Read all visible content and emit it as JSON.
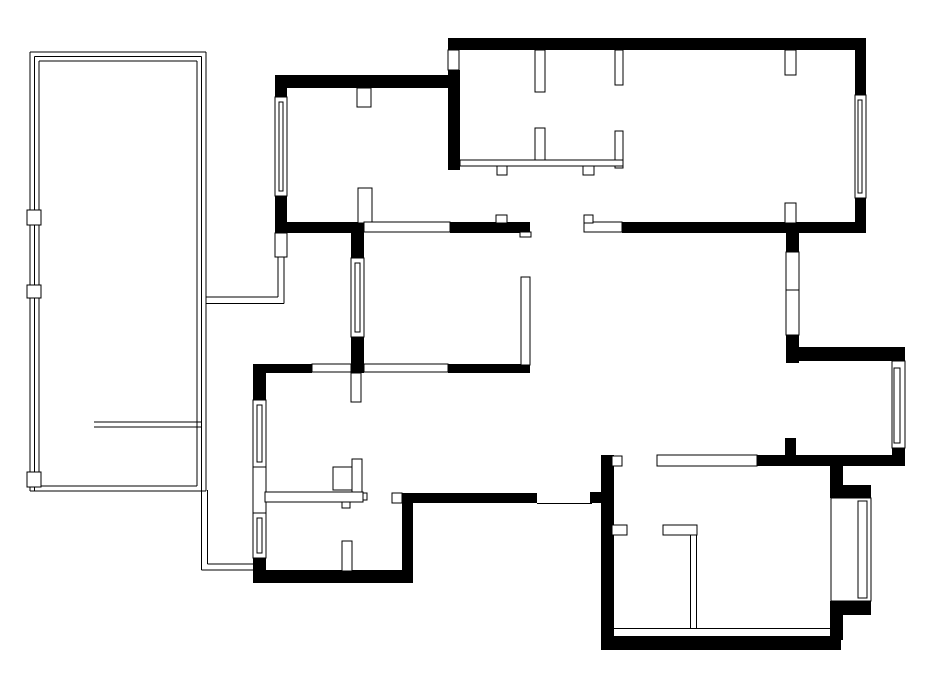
{
  "canvas": {
    "width": 934,
    "height": 674,
    "background": "#ffffff",
    "wall_color": "#000000",
    "line_color": "#000000",
    "fill_color": "#ffffff"
  },
  "walls": [
    [
      275,
      75,
      185,
      13
    ],
    [
      275,
      88,
      12,
      9
    ],
    [
      275,
      196,
      12,
      37
    ],
    [
      448,
      70,
      12,
      100
    ],
    [
      275,
      222,
      89,
      11
    ],
    [
      450,
      222,
      80,
      11
    ],
    [
      448,
      38,
      418,
      12
    ],
    [
      855,
      50,
      11,
      45
    ],
    [
      855,
      198,
      11,
      35
    ],
    [
      622,
      222,
      244,
      11
    ],
    [
      351,
      233,
      13,
      25
    ],
    [
      351,
      337,
      13,
      36
    ],
    [
      253,
      364,
      59,
      9
    ],
    [
      351,
      364,
      13,
      9
    ],
    [
      448,
      364,
      82,
      9
    ],
    [
      253,
      364,
      13,
      36
    ],
    [
      253,
      558,
      13,
      25
    ],
    [
      253,
      570,
      160,
      13
    ],
    [
      402,
      493,
      11,
      90
    ],
    [
      402,
      493,
      135,
      10
    ],
    [
      590,
      492,
      24,
      11
    ],
    [
      601,
      455,
      13,
      185
    ],
    [
      601,
      636,
      240,
      14
    ],
    [
      830,
      466,
      13,
      20
    ],
    [
      830,
      485,
      41,
      13
    ],
    [
      830,
      601,
      41,
      14
    ],
    [
      830,
      615,
      13,
      25
    ],
    [
      757,
      455,
      148,
      11
    ],
    [
      785,
      438,
      11,
      18
    ],
    [
      892,
      347,
      13,
      16
    ],
    [
      892,
      448,
      13,
      18
    ],
    [
      797,
      347,
      108,
      14
    ],
    [
      786,
      233,
      13,
      19
    ],
    [
      786,
      335,
      13,
      28
    ]
  ],
  "white_segments": [
    [
      448,
      50,
      11,
      20
    ],
    [
      535,
      50,
      10,
      42
    ],
    [
      615,
      50,
      8,
      35
    ],
    [
      785,
      50,
      11,
      25
    ],
    [
      535,
      128,
      10,
      34
    ],
    [
      615,
      131,
      8,
      37
    ],
    [
      785,
      203,
      11,
      20
    ],
    [
      357,
      88,
      14,
      19
    ],
    [
      358,
      188,
      14,
      35
    ],
    [
      275,
      233,
      12,
      24
    ],
    [
      521,
      277,
      9,
      88
    ],
    [
      520,
      232,
      11,
      5
    ],
    [
      351,
      373,
      10,
      29
    ],
    [
      342,
      541,
      10,
      30
    ],
    [
      612,
      456,
      10,
      10
    ],
    [
      612,
      525,
      15,
      10
    ],
    [
      364,
      222,
      86,
      10
    ],
    [
      584,
      222,
      38,
      10
    ],
    [
      584,
      215,
      9,
      8
    ],
    [
      496,
      215,
      11,
      8
    ],
    [
      312,
      364,
      39,
      8
    ],
    [
      364,
      364,
      84,
      8
    ],
    [
      657,
      455,
      100,
      11
    ],
    [
      663,
      525,
      34,
      10
    ],
    [
      460,
      160,
      163,
      6
    ],
    [
      497,
      166,
      10,
      9
    ],
    [
      583,
      166,
      11,
      9
    ],
    [
      253,
      467,
      13,
      46
    ],
    [
      392,
      493,
      10,
      10
    ],
    [
      786,
      252,
      13,
      38
    ],
    [
      786,
      290,
      13,
      45
    ],
    [
      265,
      492,
      98,
      10
    ],
    [
      352,
      459,
      10,
      33
    ],
    [
      333,
      467,
      19,
      23
    ],
    [
      342,
      502,
      8,
      6
    ],
    [
      363,
      493,
      4,
      7
    ]
  ],
  "windows": [
    {
      "box": [
        275,
        97,
        12,
        99
      ],
      "glass": [
        279,
        102,
        4,
        89
      ]
    },
    {
      "box": [
        351,
        258,
        13,
        79
      ],
      "glass": [
        355,
        263,
        5,
        69
      ]
    },
    {
      "box": [
        253,
        400,
        13,
        67
      ],
      "glass": [
        257,
        405,
        5,
        57
      ]
    },
    {
      "box": [
        253,
        513,
        13,
        45
      ],
      "glass": [
        257,
        518,
        5,
        35
      ]
    },
    {
      "box": [
        855,
        95,
        11,
        103
      ],
      "glass": [
        858,
        100,
        4,
        93
      ]
    },
    {
      "box": [
        892,
        361,
        13,
        87
      ],
      "glass": [
        894,
        368,
        6,
        75
      ]
    },
    {
      "box": [
        831,
        498,
        40,
        103
      ],
      "glass": [
        858,
        501,
        9,
        97
      ]
    }
  ],
  "posts": [
    [
      27,
      210,
      14,
      15
    ],
    [
      27,
      285,
      14,
      13
    ],
    [
      27,
      472,
      14,
      15
    ]
  ],
  "railing_lines": [
    [
      30,
      52,
      30,
      491
    ],
    [
      34.5,
      56.5,
      34.5,
      491
    ],
    [
      39,
      61,
      39,
      486
    ],
    [
      30,
      52,
      206,
      52
    ],
    [
      34.5,
      56.5,
      201.5,
      56.5
    ],
    [
      39,
      61,
      197,
      61
    ],
    [
      206,
      52,
      206,
      491
    ],
    [
      201.5,
      56.5,
      201.5,
      570
    ],
    [
      197,
      61,
      197,
      486
    ],
    [
      39,
      486,
      197,
      486
    ],
    [
      30,
      491,
      206,
      491
    ],
    [
      94,
      422,
      201.5,
      422
    ],
    [
      94,
      427,
      201.5,
      427
    ],
    [
      207.5,
      490,
      207.5,
      564
    ],
    [
      207.5,
      564,
      253,
      564
    ],
    [
      201.5,
      570,
      253,
      570
    ],
    [
      278,
      257,
      278,
      297
    ],
    [
      284,
      257,
      284,
      303.5
    ],
    [
      206,
      297,
      278,
      297
    ],
    [
      206,
      303.5,
      284,
      303.5
    ]
  ],
  "thin_lines": [
    [
      537,
      503.5,
      592,
      503.5
    ],
    [
      614,
      628.5,
      830,
      628.5
    ],
    [
      690.5,
      534,
      690.5,
      628.5
    ],
    [
      696.5,
      534,
      696.5,
      628.5
    ]
  ]
}
